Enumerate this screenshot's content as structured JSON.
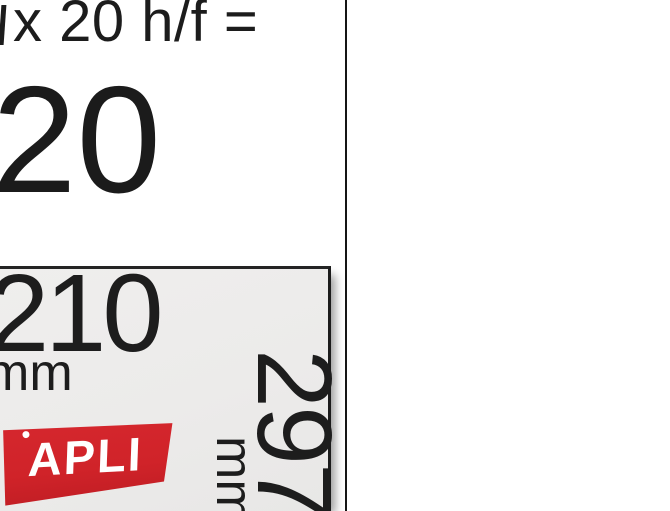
{
  "promo": {
    "formula_text": "x 20 h/f =",
    "result_value": "20"
  },
  "package": {
    "width": {
      "value": "210",
      "unit": "mm"
    },
    "height": {
      "value": "297",
      "unit": "mm"
    },
    "brand": {
      "name": "APLI"
    }
  },
  "colors": {
    "background": "#ffffff",
    "text": "#1c1c1c",
    "package_background": "#ecebea",
    "package_border": "#1c1c1c",
    "divider_line": "#151515",
    "brand_red": "#d02329",
    "brand_text": "#ffffff"
  }
}
